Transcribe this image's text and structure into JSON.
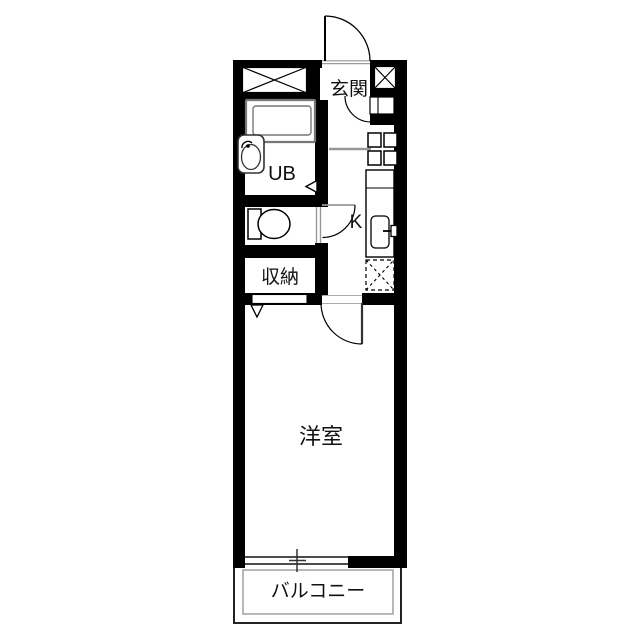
{
  "floor_plan": {
    "rooms": {
      "entrance": {
        "label": "玄関"
      },
      "unit_bath": {
        "label": "UB"
      },
      "kitchen": {
        "label": "K"
      },
      "storage": {
        "label": "収納"
      },
      "western_room": {
        "label": "洋室"
      },
      "balcony": {
        "label": "バルコニー"
      }
    },
    "fixtures": [
      "bathtub",
      "washbasin",
      "toilet",
      "stove-2burner",
      "kitchen-sink",
      "refrigerator-space",
      "pipe-shaft-top-left",
      "meter-box-entrance",
      "entrance-door",
      "toilet-door",
      "room-door",
      "closet-door",
      "sliding-window"
    ],
    "colors": {
      "wall": "#000000",
      "fixture_line": "#777777",
      "opening_line": "#999999",
      "background": "#ffffff"
    }
  }
}
